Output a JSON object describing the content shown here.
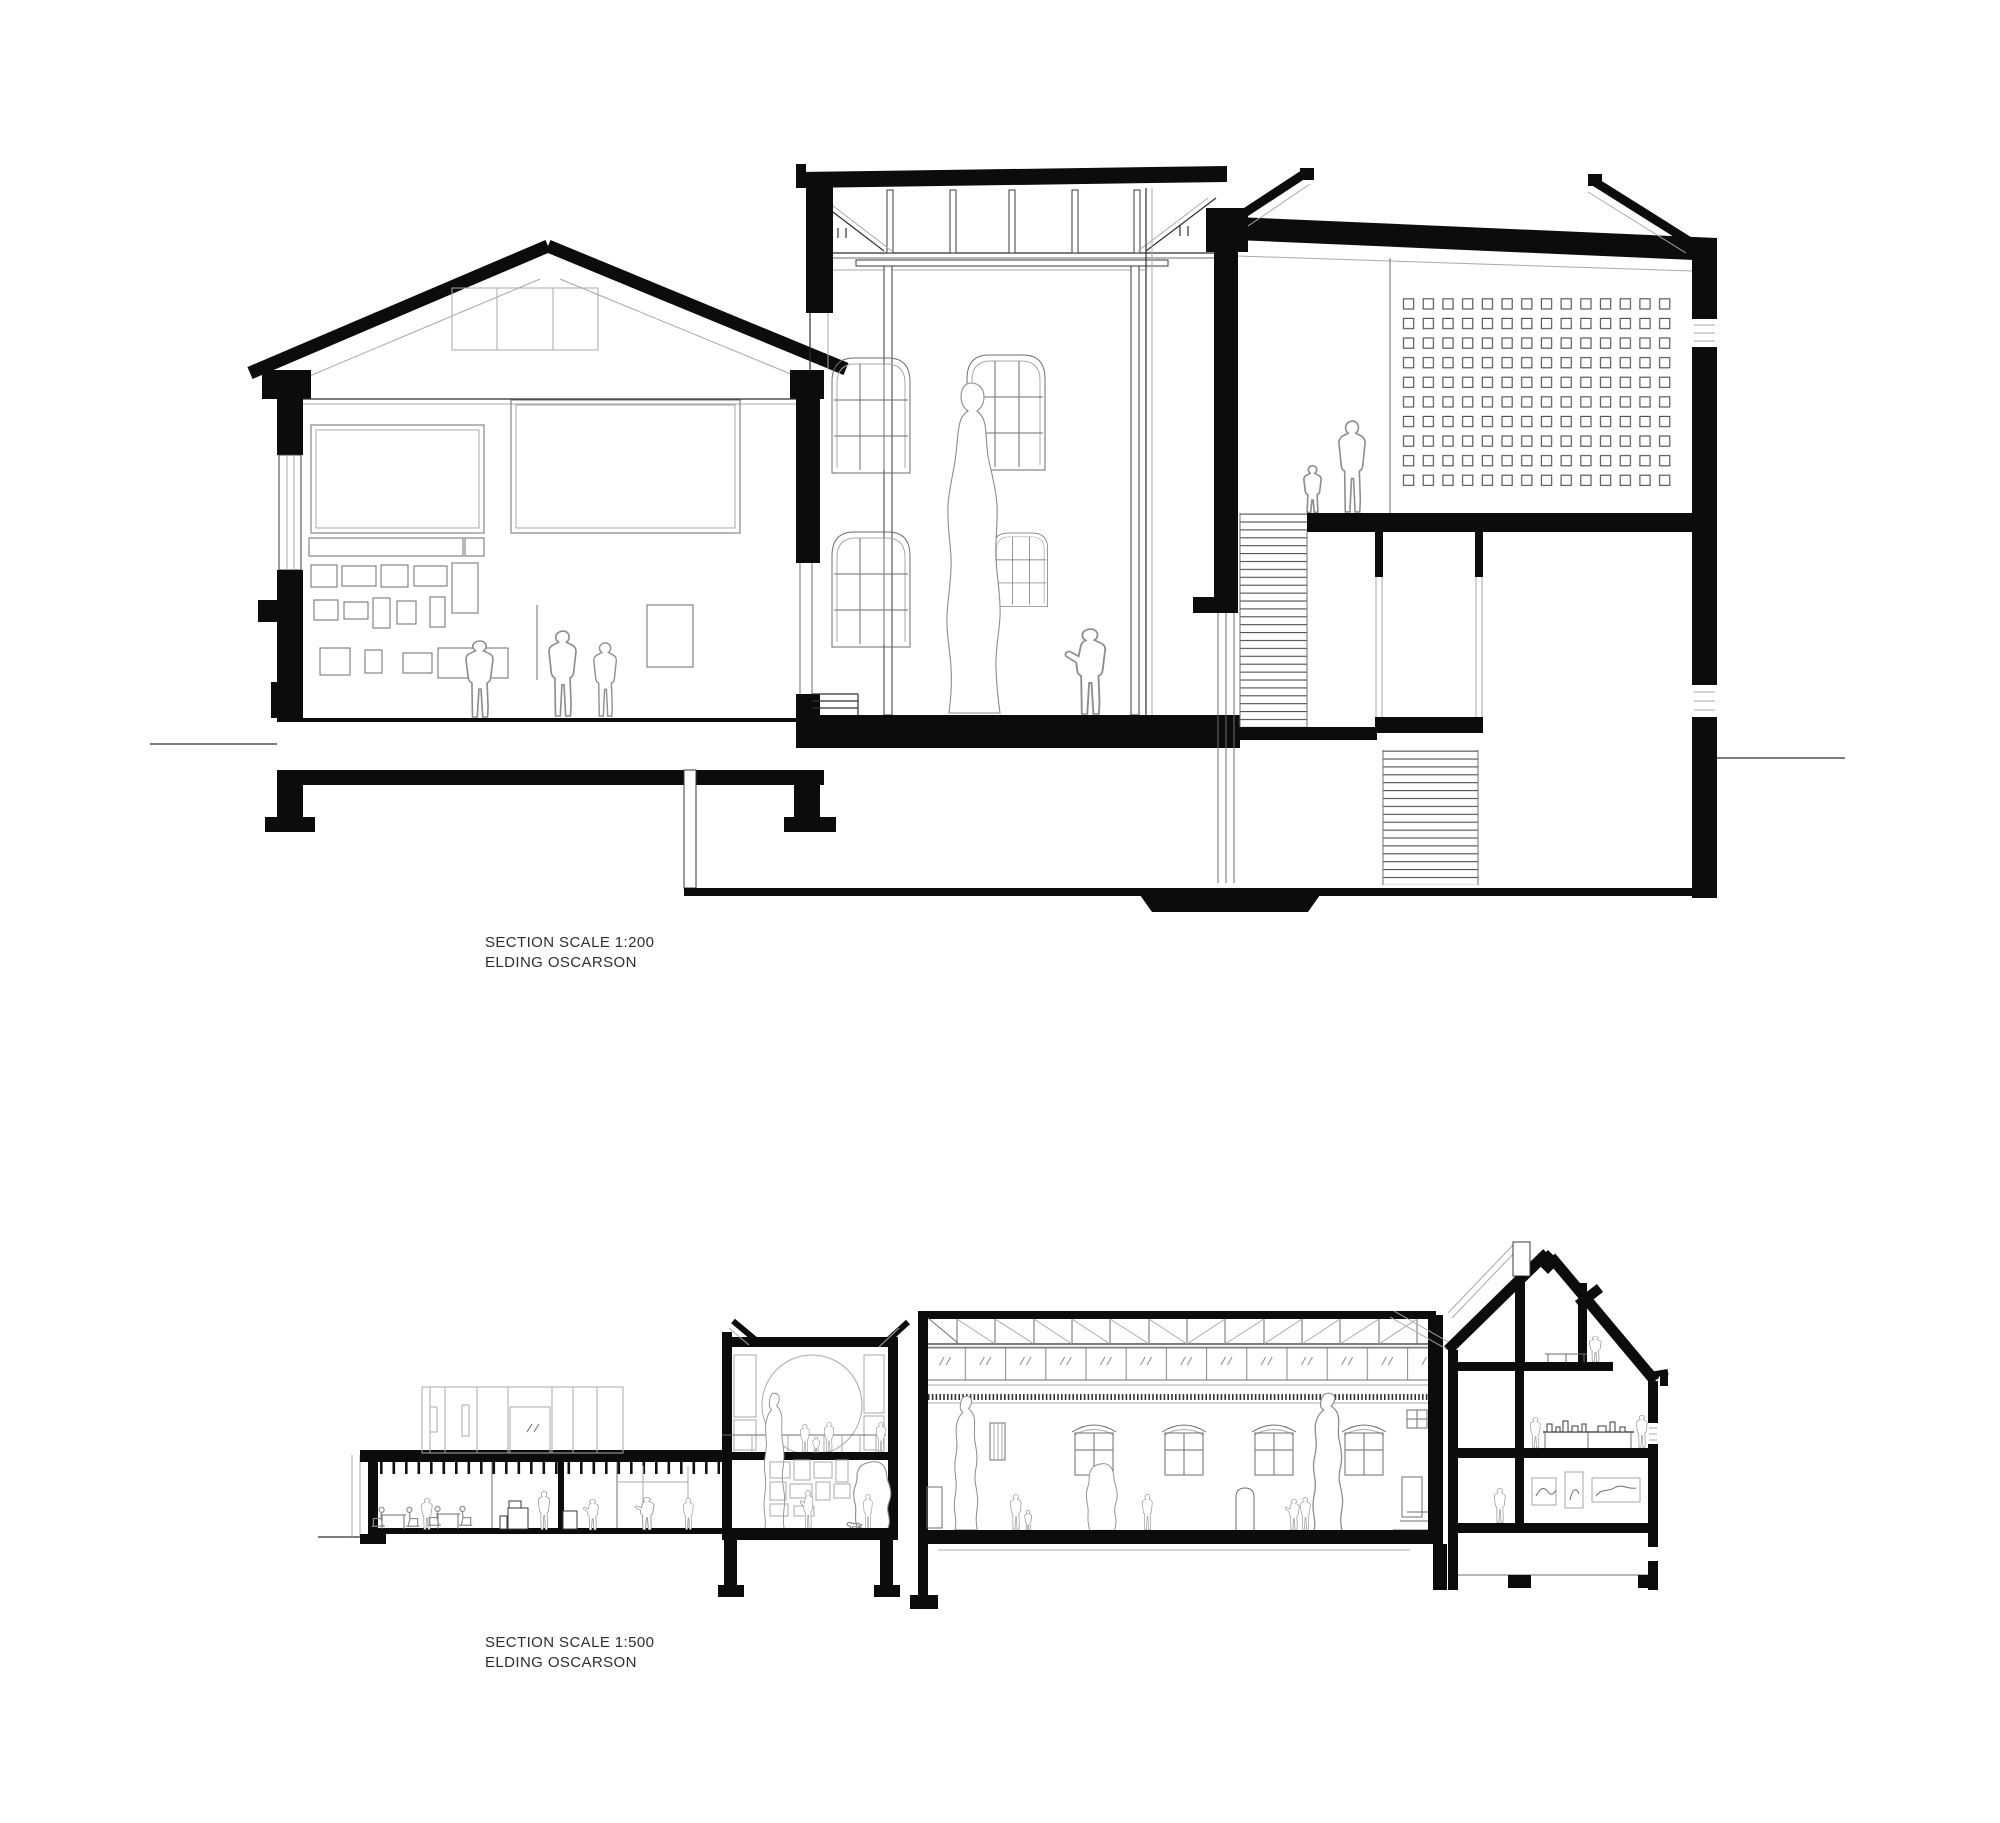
{
  "page": {
    "background_color": "#ffffff",
    "width": 2000,
    "height": 1823,
    "type": "architectural section sheet"
  },
  "colors": {
    "cut_poche": "#0c0c0c",
    "line_dark": "#2f2f2f",
    "line_medium": "#6e6e6e",
    "line_light": "#a9a9a9",
    "figure_outline": "#8d8d8d",
    "label_text": "#2e2e2e"
  },
  "sections": [
    {
      "id": "section-1-200",
      "scale_label": "SECTION SCALE 1:200",
      "firm_label": "ELDING OSCARSON",
      "buildings": [
        "left gallery pavilion with pitched roof and salon-hung artwork wall",
        "tall skylit sculpture hall with roof truss and standing statue",
        "annex with perforated screen wall, stairs and basement"
      ],
      "perforated_screen": {
        "columns": 14,
        "rows": 10
      }
    },
    {
      "id": "section-1-500",
      "scale_label": "SECTION SCALE 1:500",
      "firm_label": "ELDING OSCARSON",
      "buildings": [
        "underground cafe extension with ribbed ceiling",
        "rooftop glass volume",
        "gallery with arched niche, mezzanine and sculptures",
        "long truss-roof exhibition hall with clerestory",
        "glazed link",
        "gabled townhouse with chimney, three floors and attic"
      ]
    }
  ]
}
